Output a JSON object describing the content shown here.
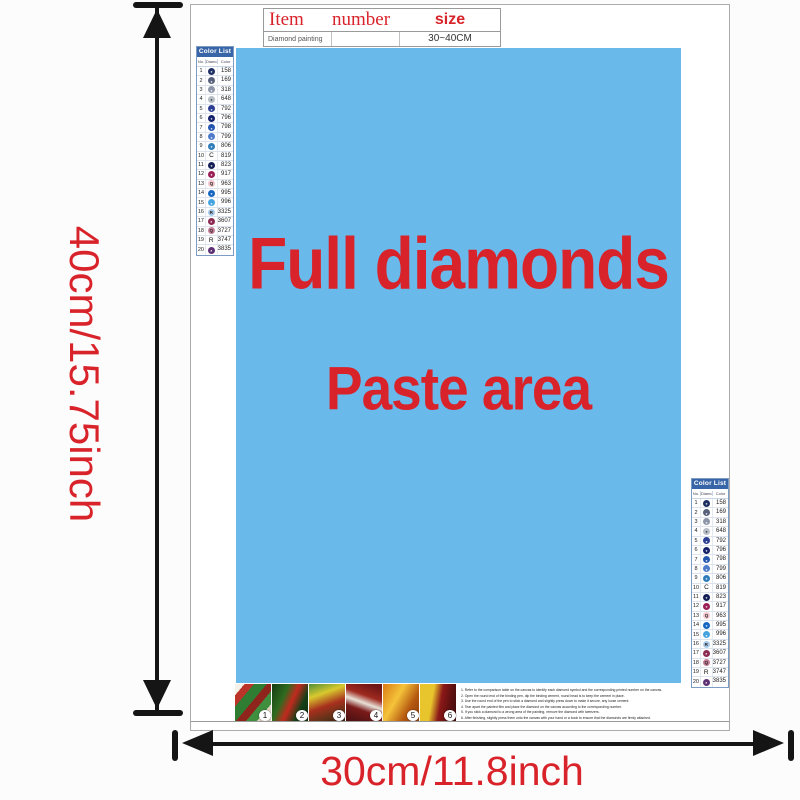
{
  "colors": {
    "paste_blue": "#69b9eb",
    "accent_red": "#d9232a",
    "list_header_blue": "#3865a8"
  },
  "dimension_labels": {
    "height": "40cm/15.75inch",
    "width": "30cm/11.8inch"
  },
  "item_table": {
    "col_item": "Item",
    "col_number": "number",
    "col_size": "size",
    "row_item": "Diamond painting",
    "row_number": "",
    "row_size": "30~40CM"
  },
  "paste_area": {
    "line1": "Full diamonds",
    "line2": "Paste area"
  },
  "color_list": {
    "title": "Color List",
    "col_no": "No.",
    "col_diamond": "Diamond",
    "col_color": "Color",
    "rows": [
      {
        "no": "1",
        "code": "158",
        "dot": "#1e2f63",
        "sym": "",
        "sym_light": true
      },
      {
        "no": "2",
        "code": "169",
        "dot": "#56607a",
        "sym": "",
        "sym_light": true
      },
      {
        "no": "3",
        "code": "318",
        "dot": "#8d96a8",
        "sym": "",
        "sym_light": true
      },
      {
        "no": "4",
        "code": "648",
        "dot": "#b6bdc6",
        "sym": "",
        "sym_light": false
      },
      {
        "no": "5",
        "code": "792",
        "dot": "#2c3f93",
        "sym": "",
        "sym_light": true
      },
      {
        "no": "6",
        "code": "796",
        "dot": "#16216b",
        "sym": "",
        "sym_light": true
      },
      {
        "no": "7",
        "code": "798",
        "dot": "#2456b0",
        "sym": "",
        "sym_light": true
      },
      {
        "no": "8",
        "code": "799",
        "dot": "#4d7ac9",
        "sym": "",
        "sym_light": true
      },
      {
        "no": "9",
        "code": "806",
        "dot": "#2e7cba",
        "sym": "",
        "sym_light": true
      },
      {
        "no": "10",
        "code": "819",
        "dot": "",
        "sym": "C",
        "sym_light": false
      },
      {
        "no": "11",
        "code": "823",
        "dot": "#131f56",
        "sym": "",
        "sym_light": true
      },
      {
        "no": "12",
        "code": "917",
        "dot": "#9a1f56",
        "sym": "",
        "sym_light": true
      },
      {
        "no": "13",
        "code": "963",
        "dot": "#f2c6cc",
        "sym": "Q",
        "sym_light": false
      },
      {
        "no": "14",
        "code": "995",
        "dot": "#1766c2",
        "sym": "",
        "sym_light": true
      },
      {
        "no": "15",
        "code": "996",
        "dot": "#45a4e0",
        "sym": "",
        "sym_light": true
      },
      {
        "no": "16",
        "code": "3325",
        "dot": "#a9c9e8",
        "sym": "R",
        "sym_light": false
      },
      {
        "no": "17",
        "code": "3607",
        "dot": "#8c2a52",
        "sym": "",
        "sym_light": true
      },
      {
        "no": "18",
        "code": "3727",
        "dot": "#c57e97",
        "sym": "Q",
        "sym_light": false
      },
      {
        "no": "19",
        "code": "3747",
        "dot": "",
        "sym": "R",
        "sym_light": false
      },
      {
        "no": "20",
        "code": "3835",
        "dot": "#5d3173",
        "sym": "",
        "sym_light": true
      }
    ]
  },
  "steps": [
    "1",
    "2",
    "3",
    "4",
    "5",
    "6"
  ],
  "instructions": [
    "1. Refer to the comparison table on the canvas to identify each diamond symbol and the corresponding printed number on the canvas.",
    "2. Open the round end of the binding pen, dip the binding cement, round head is to keep the cement in place.",
    "3. Use the round end of the pen to stick a diamond and slightly press down to make it secure, any loose cement.",
    "4. Tear apart the painted film and place the diamond on the canvas according to the corresponding number.",
    "5. If you stick a diamond to a wrong area of the painting, remove the diamond with tweezers.",
    "6. After finishing, slightly press them onto the canvas with your hand or a book to ensure that the diamonds are firmly attached."
  ]
}
